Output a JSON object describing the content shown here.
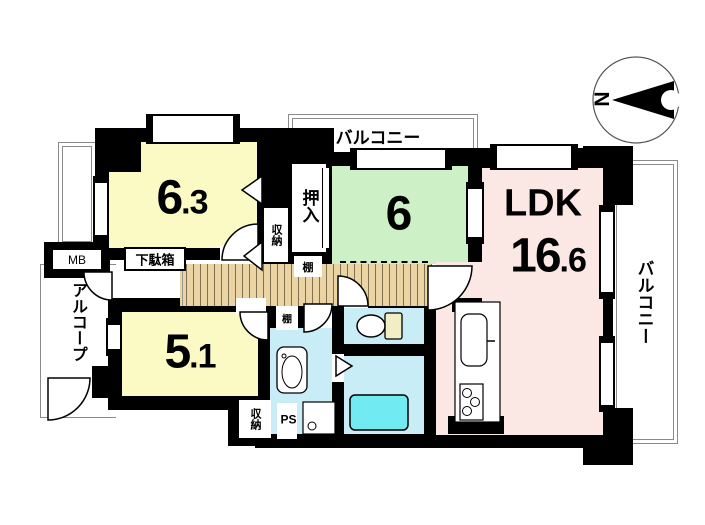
{
  "meta": {
    "type": "apartment-floor-plan"
  },
  "compass": {
    "label": "N"
  },
  "rooms": {
    "bedroom1": {
      "size_main": "6",
      "size_sub": ".3"
    },
    "bedroom2": {
      "size_main": "6",
      "size_sub": ""
    },
    "bedroom3": {
      "size_main": "5",
      "size_sub": ".1"
    },
    "ldk": {
      "name": "LDK",
      "size_main": "16",
      "size_sub": ".6"
    }
  },
  "balconies": {
    "top": "バルコニー",
    "right": "バルコニー"
  },
  "features": {
    "oshiire": "押入",
    "storage1": "収納",
    "storage2": "収納",
    "shelf1": "棚",
    "shelf2": "棚",
    "meter_box": "MB",
    "shoe_cabinet": "下駄箱",
    "alcove": "アルコープ",
    "pipe_space": "PS"
  },
  "colors": {
    "bedroom": "#FBFAC5",
    "bedroom_green": "#CDF0C6",
    "ldk": "#FBE7E3",
    "wet_room": "#C9EDF7",
    "bathtub": "#72EAF2",
    "corridor": "#EAD4A4",
    "toilet_tank": "#F1EDC4",
    "wall": "#000000"
  }
}
